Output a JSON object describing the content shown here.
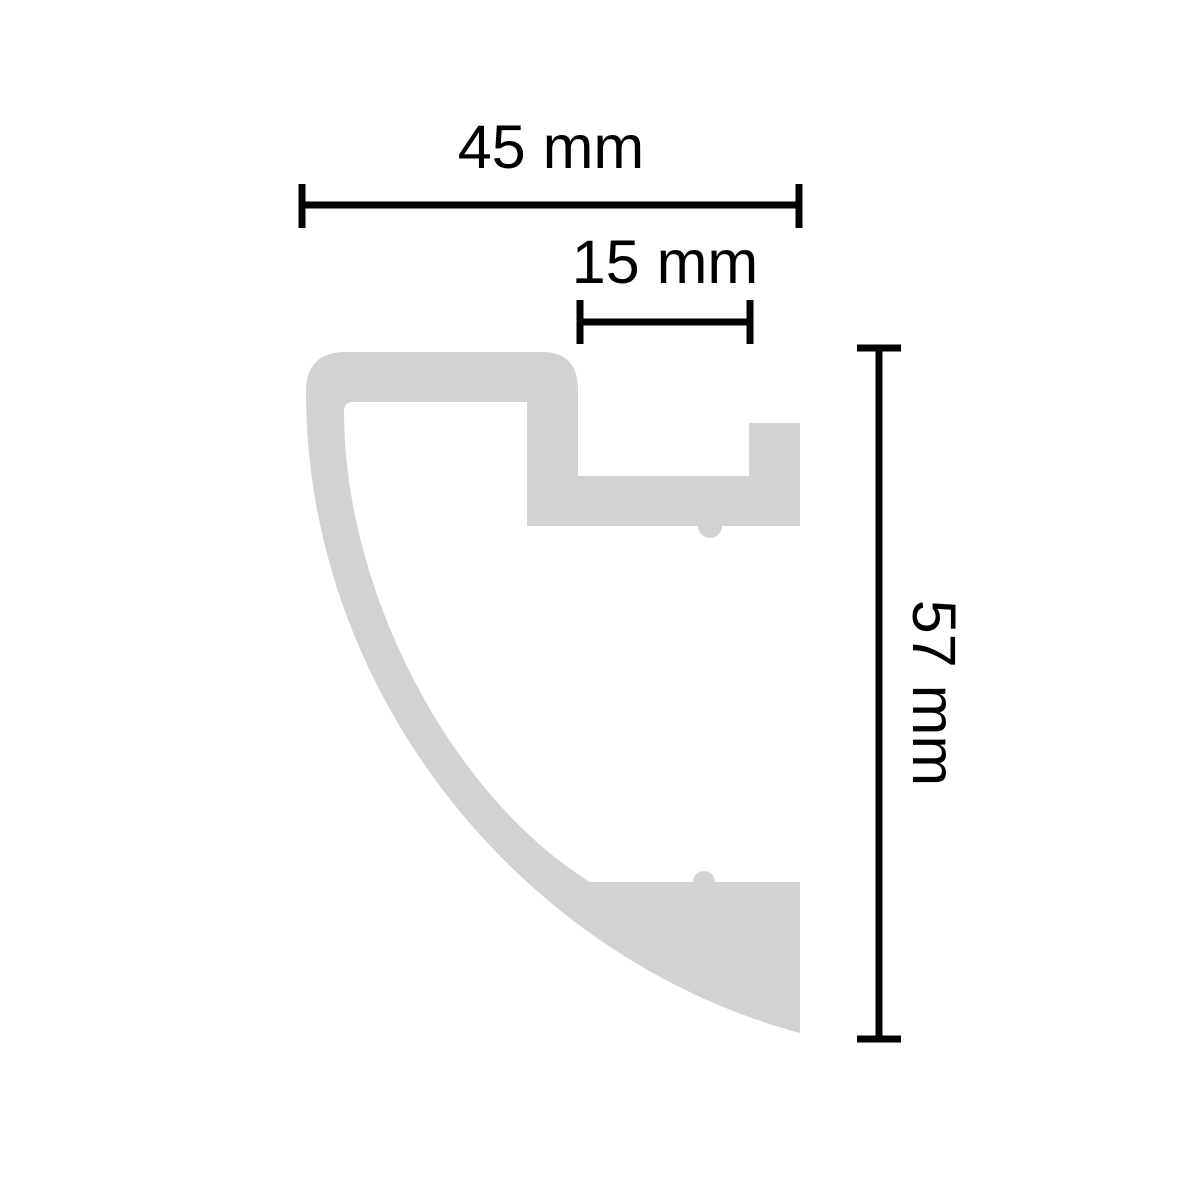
{
  "drawing": {
    "subject": "moulding-profile-cross-section",
    "background_color": "#ffffff",
    "shape_color": "#d2d2d2",
    "dimension_color": "#000000",
    "dimensions": {
      "width": {
        "value": "45",
        "unit": "mm",
        "label": "45 mm"
      },
      "inner_ledge": {
        "value": "15",
        "unit": "mm",
        "label": "15 mm"
      },
      "height": {
        "value": "57",
        "unit": "mm",
        "label": "57 mm"
      }
    }
  }
}
